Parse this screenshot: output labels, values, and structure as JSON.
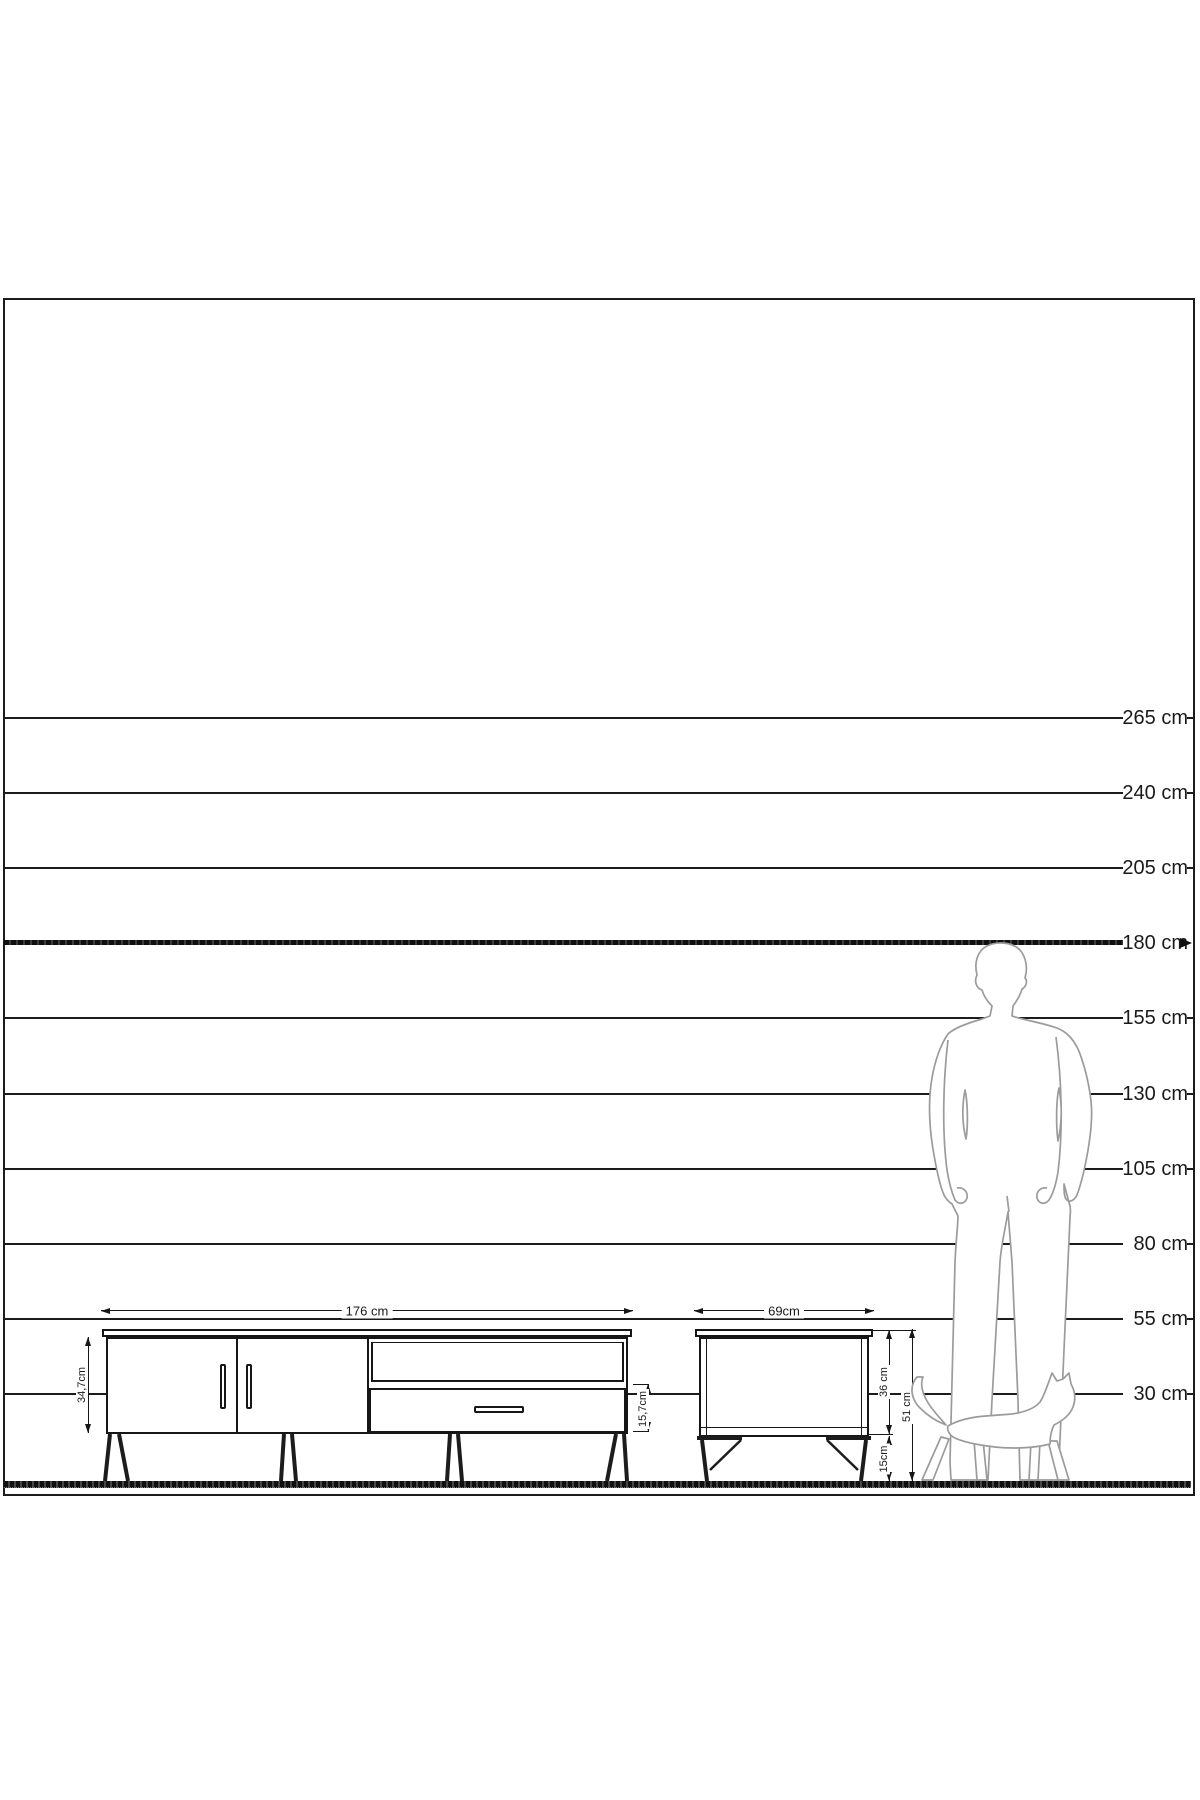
{
  "figure": {
    "title": "furniture-size-comparison-diagram",
    "scale": {
      "labels": [
        {
          "text": "265 cm",
          "bold": false
        },
        {
          "text": "240 cm",
          "bold": false
        },
        {
          "text": "205 cm",
          "bold": false
        },
        {
          "text": "180 cm",
          "bold": true
        },
        {
          "text": "155 cm",
          "bold": false
        },
        {
          "text": "130 cm",
          "bold": false
        },
        {
          "text": "105 cm",
          "bold": false
        },
        {
          "text": "80 cm",
          "bold": false
        },
        {
          "text": "55 cm",
          "bold": false
        },
        {
          "text": "30 cm",
          "bold": false
        }
      ]
    },
    "tv_stand": {
      "width_label": "176 cm",
      "body_height_label": "34,7cm",
      "drawer_height_label": "15,7cm"
    },
    "side_table": {
      "width_label": "69cm",
      "body_height_label": "36 cm",
      "leg_height_label": "15cm",
      "total_height_label": "51 cm"
    },
    "silhouettes": {
      "man": "man-180cm-silhouette",
      "cat": "walking-cat-silhouette"
    }
  },
  "colors": {
    "line": "#1c1c1c",
    "silhouette_stroke": "#9b9b9b",
    "background": "#ffffff"
  }
}
